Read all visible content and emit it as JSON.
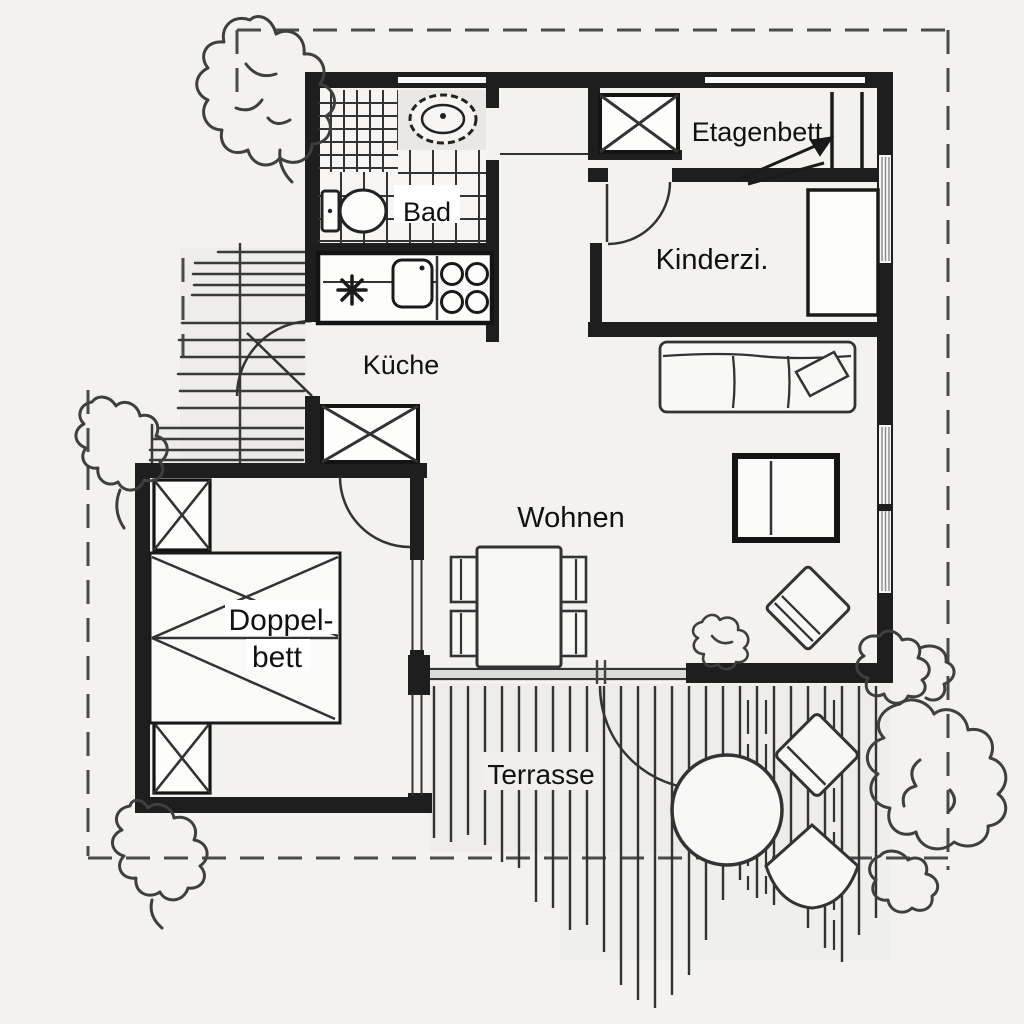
{
  "floor_plan": {
    "labels": {
      "bad": "Bad",
      "etagenbett": "Etagenbett",
      "kinderzimmer": "Kinderzi.",
      "kueche": "Küche",
      "wohnen": "Wohnen",
      "doppelbett_line1": "Doppel-",
      "doppelbett_line2": "bett",
      "terrasse": "Terrasse"
    },
    "colors": {
      "background": "#f3f2ef",
      "wall": "#1e1e1e",
      "line": "#333333",
      "boundary_dash": "#4a4a4a",
      "label_text": "#111111"
    }
  }
}
